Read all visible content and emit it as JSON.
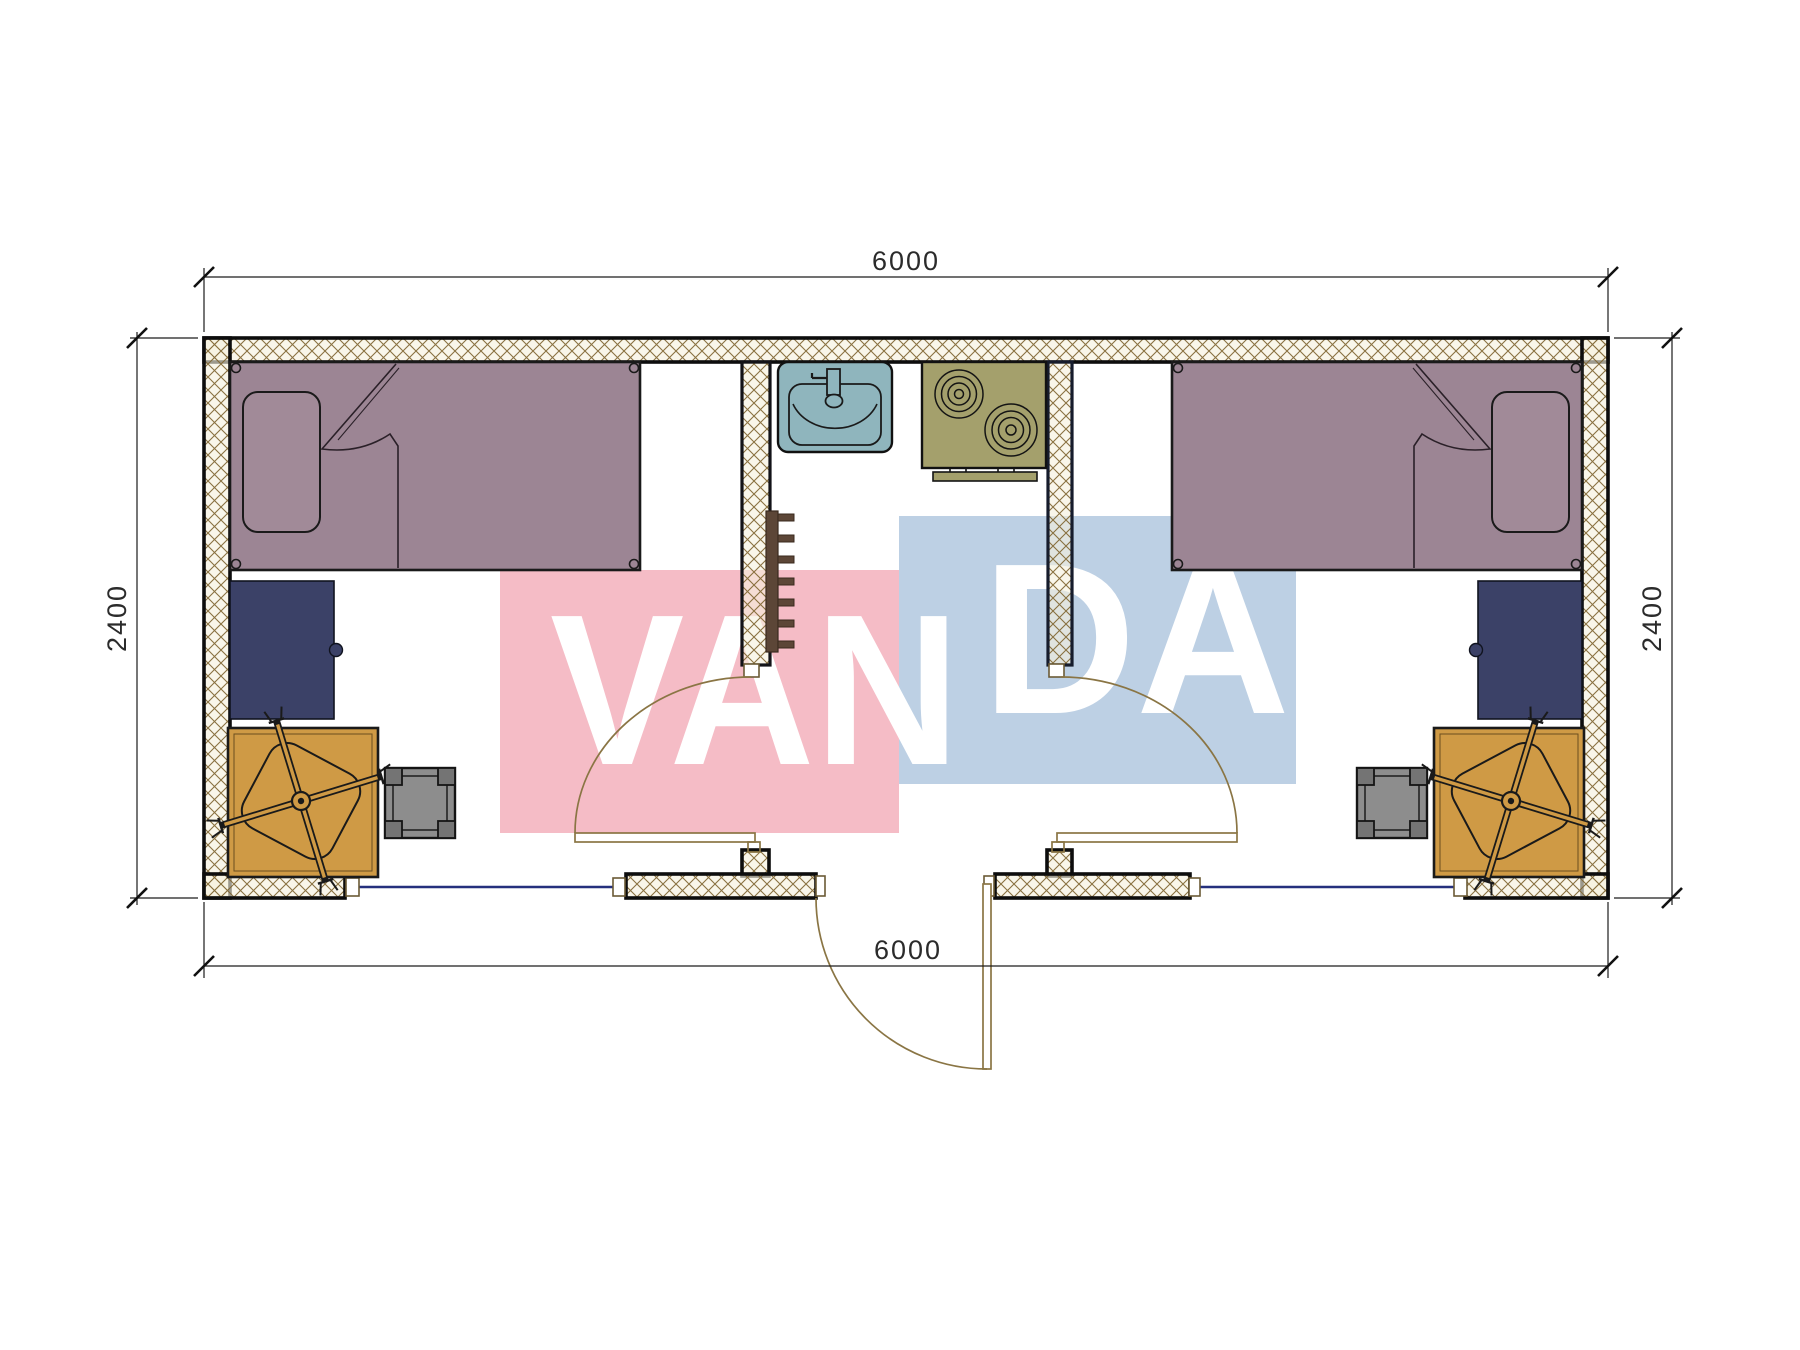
{
  "plan": {
    "type": "floor-plan",
    "unit_note": "millimetre dimension labels visible on drawing",
    "dimensions": {
      "top": "6000",
      "bottom": "6000",
      "left": "2400",
      "right": "2400"
    },
    "watermark": {
      "text_left": "VAN",
      "text_right": "DA",
      "full_text": "VANDA",
      "pink_block": "#f5bcc6",
      "blue_block": "#bdd0e4",
      "letter_color": "#ffffff"
    },
    "colors": {
      "bed": "#9c8594",
      "bed_outline": "#1a1a1a",
      "desk": "#3b4167",
      "table": "#cf9a45",
      "stool": "#8d8d8d",
      "stool_leg": "#747474",
      "sink": "#8fb5bd",
      "stove": "#a4a06c",
      "rail": "#5c4637",
      "door_line": "#8a7544",
      "window_line": "#25307d",
      "wall_hatch_line": "#826a34",
      "dimension_line": "#1c1c1c"
    },
    "rooms": {
      "left_bedroom": {
        "furniture": [
          "single-bed",
          "pillow",
          "desk",
          "table-with-office-chair",
          "stool"
        ]
      },
      "center_hall": {
        "fixtures": [
          "wash-basin",
          "two-burner-cooktop",
          "coat-rail",
          "entrance-door",
          "room-door-left",
          "room-door-right",
          "window-left",
          "window-right"
        ]
      },
      "right_bedroom": {
        "furniture": [
          "single-bed",
          "pillow",
          "desk",
          "table-with-office-chair",
          "stool"
        ]
      }
    }
  }
}
